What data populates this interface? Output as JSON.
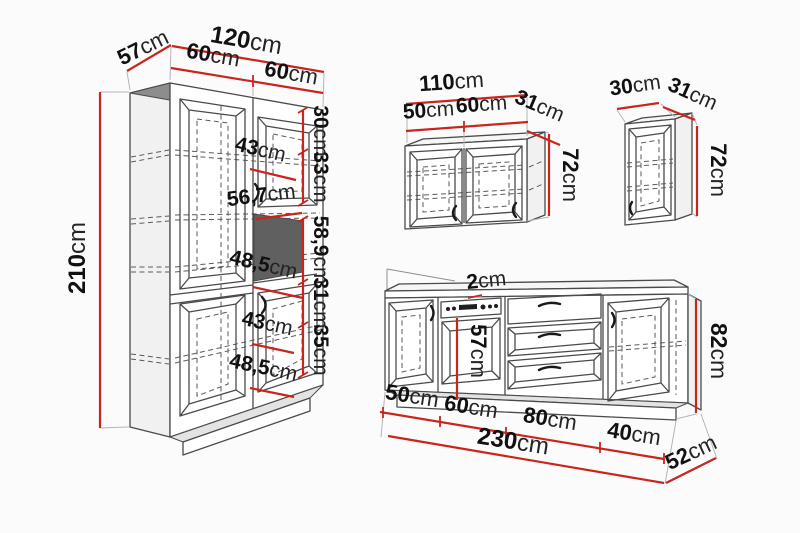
{
  "colors": {
    "red": "#c9251d",
    "line": "#4a4a4a",
    "dash": "#5a5a5a",
    "band": "#8d8d8d",
    "niche": "#606060",
    "ext": "#b5b5b5",
    "bg": "#fbfbfb",
    "text": "#111111"
  },
  "tall_cabinet": {
    "total_width": {
      "v": "120",
      "u": "cm"
    },
    "depth": {
      "v": "57",
      "u": "cm"
    },
    "left_door_width": {
      "v": "60",
      "u": "cm"
    },
    "right_door_width": {
      "v": "60",
      "u": "cm"
    },
    "height": {
      "v": "210",
      "u": "cm"
    },
    "top_compartment_height": {
      "v": "30",
      "u": "cm"
    },
    "upper_door_height": {
      "v": "33",
      "u": "cm"
    },
    "niche_width": {
      "v": "56,7",
      "u": "cm"
    },
    "niche_height": {
      "v": "58,9",
      "u": "cm"
    },
    "lower_compartment_height": {
      "v": "31",
      "u": "cm"
    },
    "lower_door_height": {
      "v": "35",
      "u": "cm"
    },
    "upper_inner_width": {
      "v": "43",
      "u": "cm"
    },
    "upper_inner_depth": {
      "v": "48,5",
      "u": "cm"
    },
    "lower_inner_width": {
      "v": "43",
      "u": "cm"
    },
    "lower_inner_depth": {
      "v": "48,5",
      "u": "cm"
    }
  },
  "wall_cabinet_double": {
    "total_width": {
      "v": "110",
      "u": "cm"
    },
    "left_door_width": {
      "v": "50",
      "u": "cm"
    },
    "right_door_width": {
      "v": "60",
      "u": "cm"
    },
    "depth": {
      "v": "31",
      "u": "cm"
    },
    "height": {
      "v": "72",
      "u": "cm"
    }
  },
  "wall_cabinet_single": {
    "width": {
      "v": "30",
      "u": "cm"
    },
    "depth": {
      "v": "31",
      "u": "cm"
    },
    "height": {
      "v": "72",
      "u": "cm"
    }
  },
  "base_unit": {
    "countertop_thickness": {
      "v": "2",
      "u": "cm"
    },
    "oven_height": {
      "v": "57",
      "u": "cm"
    },
    "height": {
      "v": "82",
      "u": "cm"
    },
    "section_1_width": {
      "v": "50",
      "u": "cm"
    },
    "section_2_width": {
      "v": "60",
      "u": "cm"
    },
    "section_3_width": {
      "v": "80",
      "u": "cm"
    },
    "section_4_width": {
      "v": "40",
      "u": "cm"
    },
    "total_width": {
      "v": "230",
      "u": "cm"
    },
    "depth": {
      "v": "52",
      "u": "cm"
    }
  }
}
